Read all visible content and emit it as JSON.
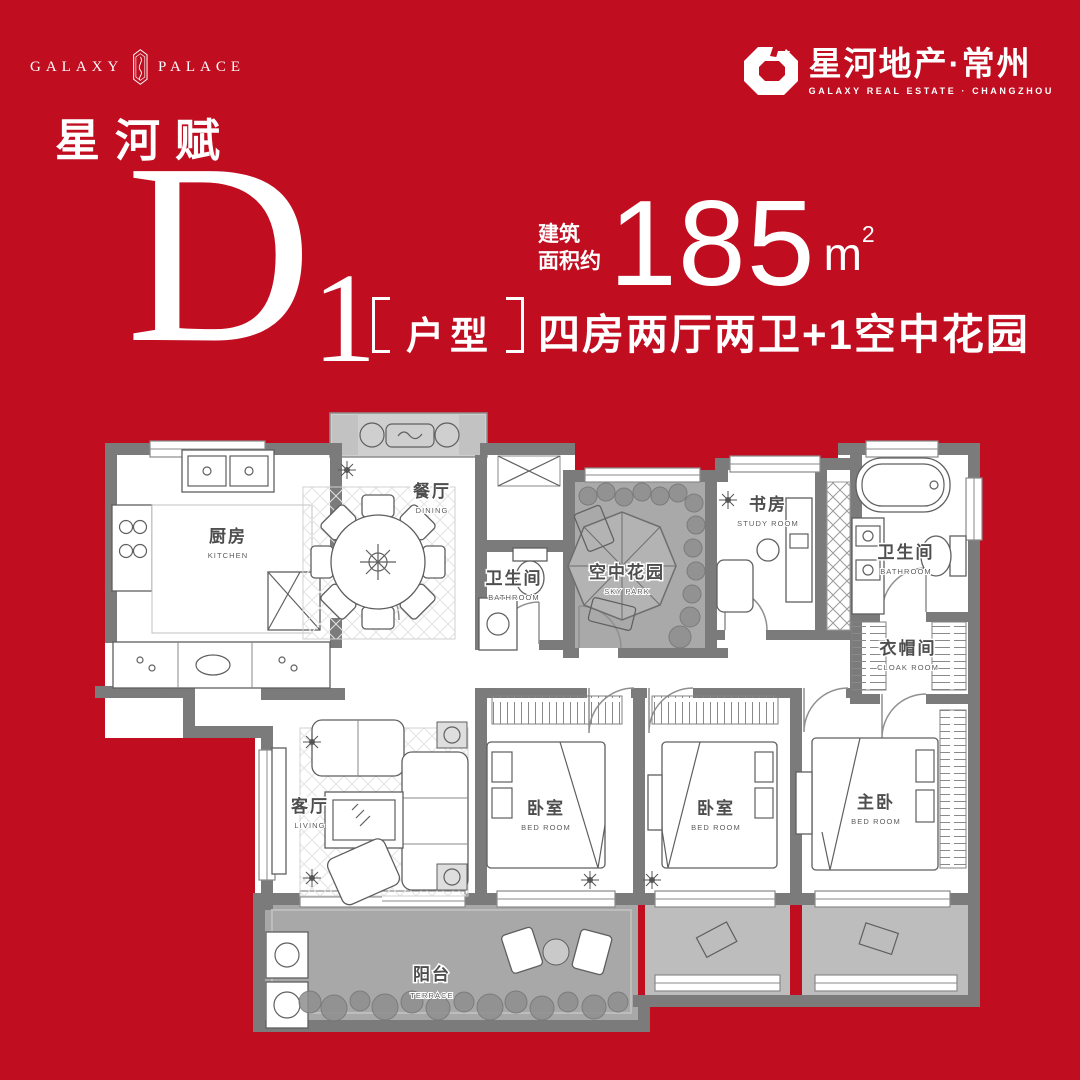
{
  "colors": {
    "background_red": "#c00d20",
    "wall_gray": "#7b7b7b",
    "shade_gray": "#a8a8a8",
    "balcony_gray": "#bdbdbd",
    "white": "#ffffff"
  },
  "header": {
    "logo_left": {
      "word1": "GALAXY",
      "word2": "PALACE",
      "cn": "星河赋"
    },
    "logo_right": {
      "zh": "星河地产·常州",
      "en": "GALAXY REAL ESTATE · CHANGZHOU"
    }
  },
  "unit": {
    "letter": "D",
    "number": "1",
    "tag": "户型",
    "area_label_line1": "建筑",
    "area_label_line2": "面积约",
    "area_value": "185",
    "area_unit": "m",
    "area_sup": "2",
    "description": "四房两厅两卫+1空中花园"
  },
  "plan": {
    "rooms": [
      {
        "zh": "厨房",
        "en": "KITCHEN"
      },
      {
        "zh": "餐厅",
        "en": "DINING"
      },
      {
        "zh": "卫生间",
        "en": "BATHROOM"
      },
      {
        "zh": "空中花园",
        "en": "SKY PARK"
      },
      {
        "zh": "书房",
        "en": "STUDY ROOM"
      },
      {
        "zh": "卫生间",
        "en": "BATHROOM"
      },
      {
        "zh": "衣帽间",
        "en": "CLOAK ROOM"
      },
      {
        "zh": "客厅",
        "en": "LIVING"
      },
      {
        "zh": "卧室",
        "en": "BED ROOM"
      },
      {
        "zh": "卧室",
        "en": "BED ROOM"
      },
      {
        "zh": "主卧",
        "en": "BED ROOM"
      },
      {
        "zh": "阳台",
        "en": "TERRACE"
      }
    ]
  }
}
